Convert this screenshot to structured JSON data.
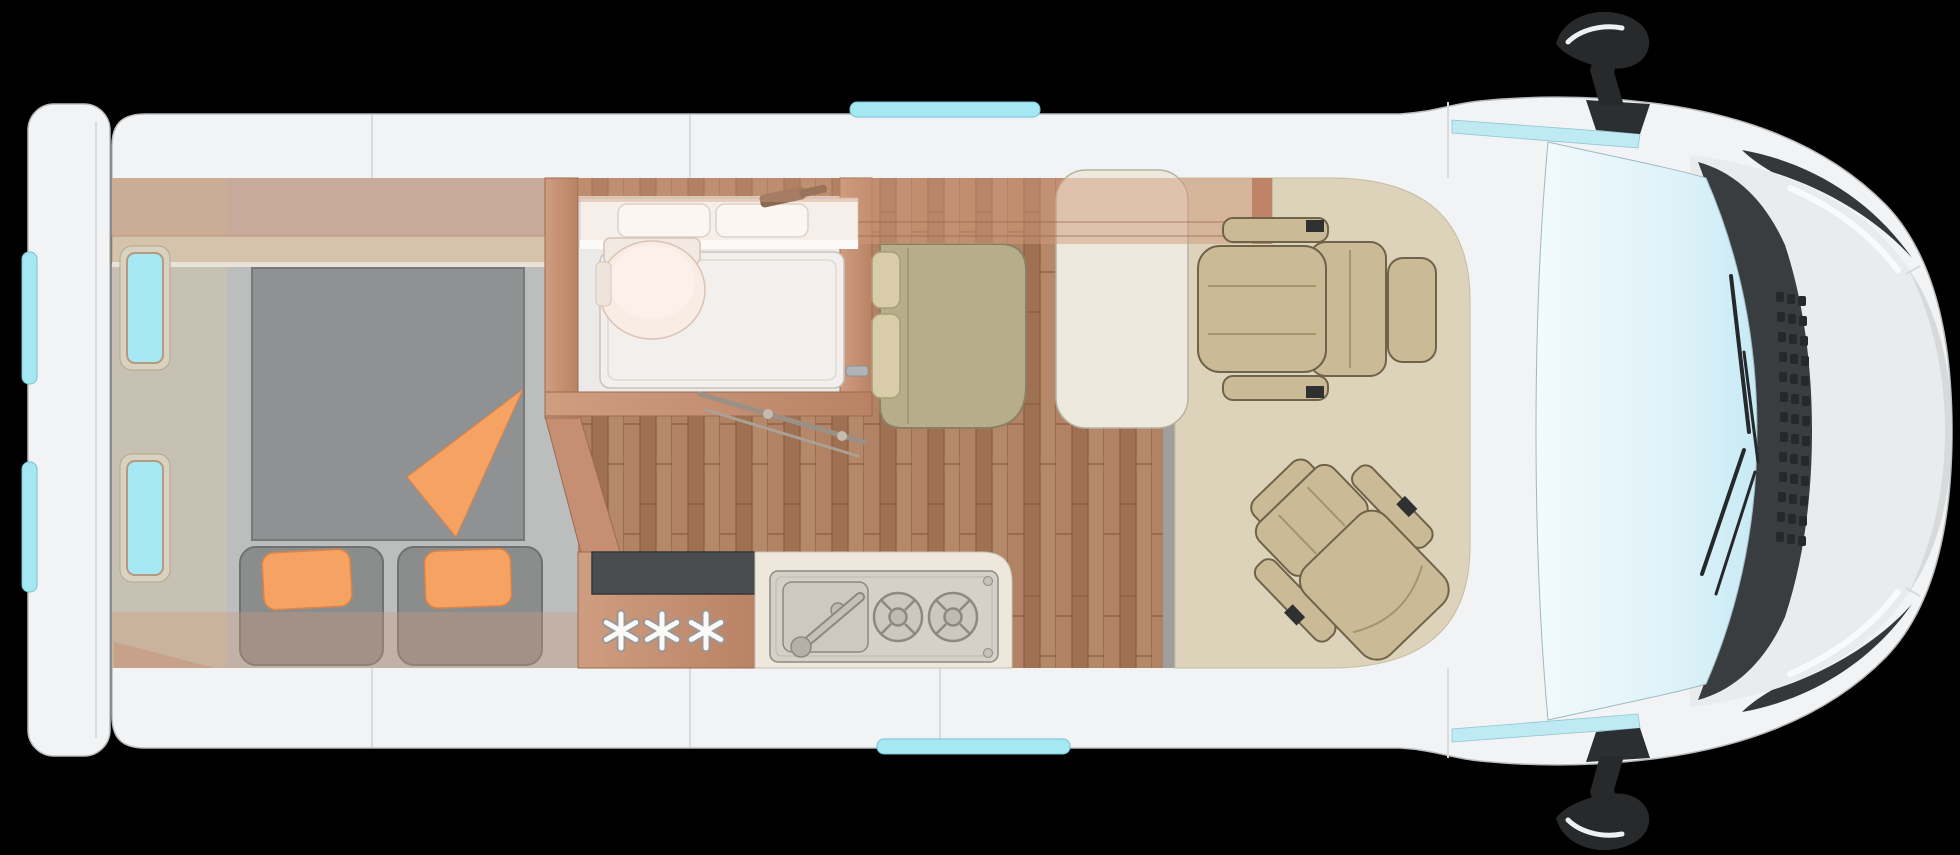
{
  "scene": {
    "title": "Campervan floor plan - top view, cab at right",
    "view": "top-down cutaway",
    "vehicle_orientation": "nose-right"
  },
  "kitchen": {
    "fridge_symbol": "***",
    "fridge_symbol_count": 3,
    "burner_count": 2,
    "sink_count": 1
  },
  "bathroom": {
    "basin_count": 2,
    "toilet_count": 1,
    "shower_count": 1
  },
  "bedroom": {
    "pillow_count": 2,
    "window_count": 2
  },
  "cab": {
    "swivel_seat_count": 2,
    "mirror_count": 2,
    "wiper_count": 2
  },
  "colors": {
    "background": "#000000",
    "body_white": "#f2f3f4",
    "body_outline": "#b9bbbd",
    "roof_seam": "#d8dadc",
    "window_cyan": "#a6e7f4",
    "window_frame_tan": "#b59a82",
    "windshield_light": "#f2fafc",
    "windshield_deep": "#c7eaf5",
    "wood_wall": "#c68f74",
    "wood_dark": "#9c6b50",
    "overhead_wood": "#cf9a7c",
    "bedroom_gray": "#bcbdbd",
    "wall_band": "#c6c1b3",
    "mattress_gray": "#909192",
    "cushion_gray": "#8b8d8c",
    "orange": "#f5a263",
    "orange_dark": "#dd8345",
    "bath_white": "#eceae8",
    "shower_white": "#f2efec",
    "toilet_pink": "#f8ece5",
    "vanity_cream": "#f6efe9",
    "khaki_bench": "#b7ad8a",
    "khaki_dark": "#847b5c",
    "headrest_cream": "#d8cda8",
    "table_cream": "#edeadd",
    "cab_floor_beige": "#ddd3bb",
    "seat_tan": "#cabb96",
    "seat_dark": "#6f6349",
    "steel": "#d6d0c9",
    "steel_dark": "#8e8880",
    "counter_dark": "#4a4c4e",
    "threshold": "#a09f9d",
    "trim_dark": "#3a3d40",
    "grille_dark": "#26292b",
    "hood_gray": "#e9ebed",
    "bumper_gray": "#d7d9db",
    "mirror_black": "#27292b",
    "star_white": "#fafaf9",
    "star_outline": "#9a9896",
    "wood_floor_base": "#aa7b5d"
  }
}
